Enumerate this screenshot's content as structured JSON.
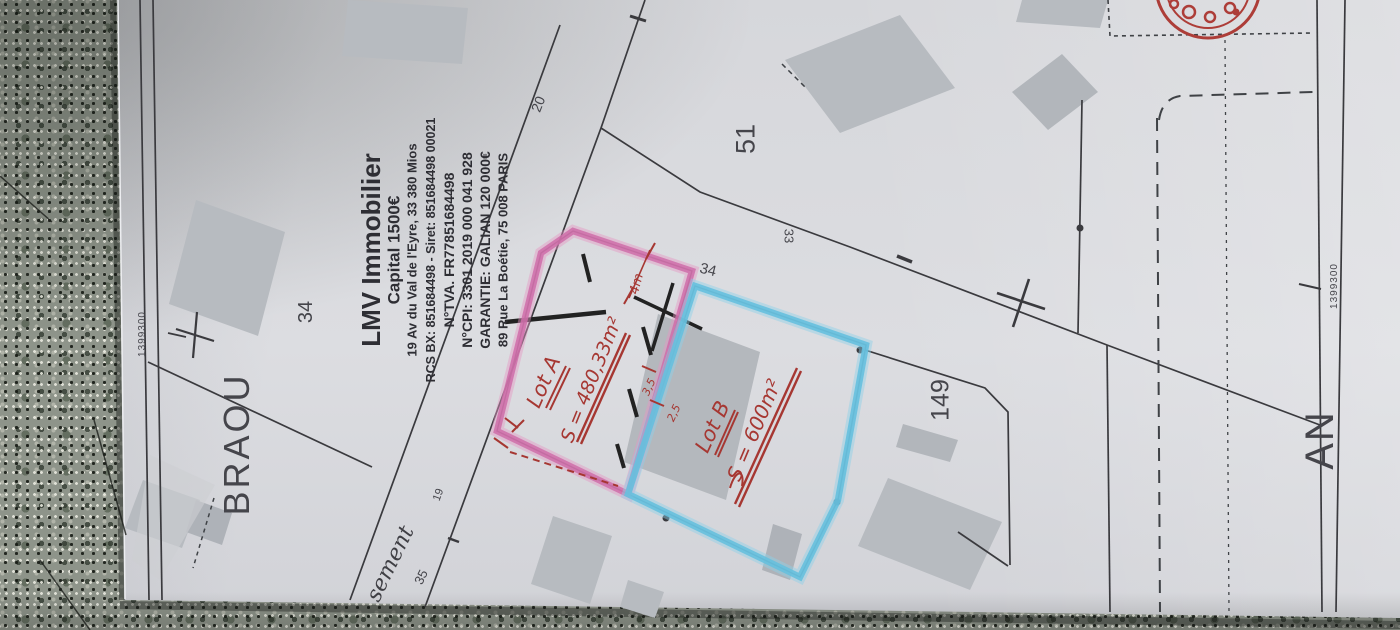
{
  "document_type": "photographed cadastral plan with realtor stamp and hand-drawn lot annotations",
  "colors": {
    "paper": "#d9dadf",
    "plan-line": "#3a3a3e",
    "building": "#b7bbc0",
    "pink-highlight": "#cf6da9",
    "blue-highlight": "#66c0de",
    "red-ink": "#a63732",
    "stamp-text": "#2e2e34",
    "granite": "#8e948a"
  },
  "plan": {
    "area_label": "BRAOU",
    "section_label": "AN",
    "coord_left": "1399300",
    "coord_right": "1399300",
    "street_partial": "sement",
    "parcels": {
      "a34": "34",
      "b34": "34",
      "n51": "51",
      "n33": "33",
      "n149": "149",
      "n20": "20",
      "n35": "35",
      "n19": "19"
    }
  },
  "stamp": {
    "lines": [
      "LMV Immobilier",
      "Capital 1500€",
      "19 Av du Val de l'Eyre, 33 380 Mios",
      "RCS BX: 851684498 - Siret: 851684498 00021",
      "N°TVA. FR77851684498",
      "N°CPI: 3301 2019 000 041 928",
      "GARANTIE: GALIAN 120 000€",
      "89 Rue La Boétie, 75 008 PARIS"
    ]
  },
  "annotations": {
    "lot_a": {
      "label": "Lot A",
      "area": "S = 480,33m²"
    },
    "lot_b": {
      "label": "Lot B",
      "area": "S = 600m²"
    },
    "dims": {
      "d4": "4m",
      "d35": "3,5",
      "d25": "2,5"
    }
  }
}
